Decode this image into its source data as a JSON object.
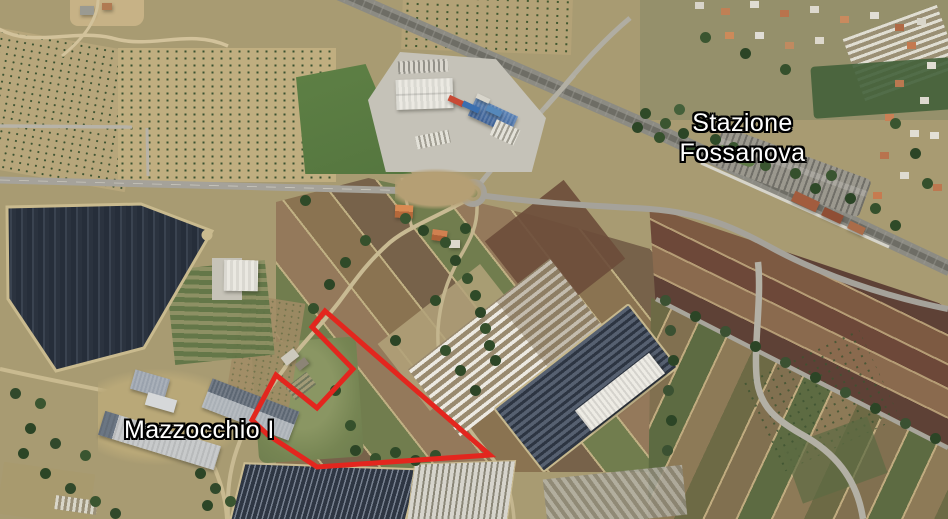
{
  "view": {
    "type": "satellite",
    "width": 948,
    "height": 519
  },
  "map_labels": {
    "stazione": {
      "line1": "Stazione",
      "line2": "Fossanova"
    },
    "mazzocchio": {
      "label": "Mazzocchio I"
    }
  },
  "annotation_polygon": {
    "color": "#e3261e",
    "stroke_width": 5,
    "points": [
      [
        325,
        311
      ],
      [
        490,
        455
      ],
      [
        317,
        467
      ],
      [
        268,
        435
      ],
      [
        252,
        420
      ],
      [
        276,
        375
      ],
      [
        317,
        408
      ],
      [
        353,
        369
      ],
      [
        312,
        327
      ]
    ]
  },
  "palette": {
    "annotation_red": "#e3261e",
    "label_text": "#ffffff",
    "label_outline": "#000000"
  }
}
